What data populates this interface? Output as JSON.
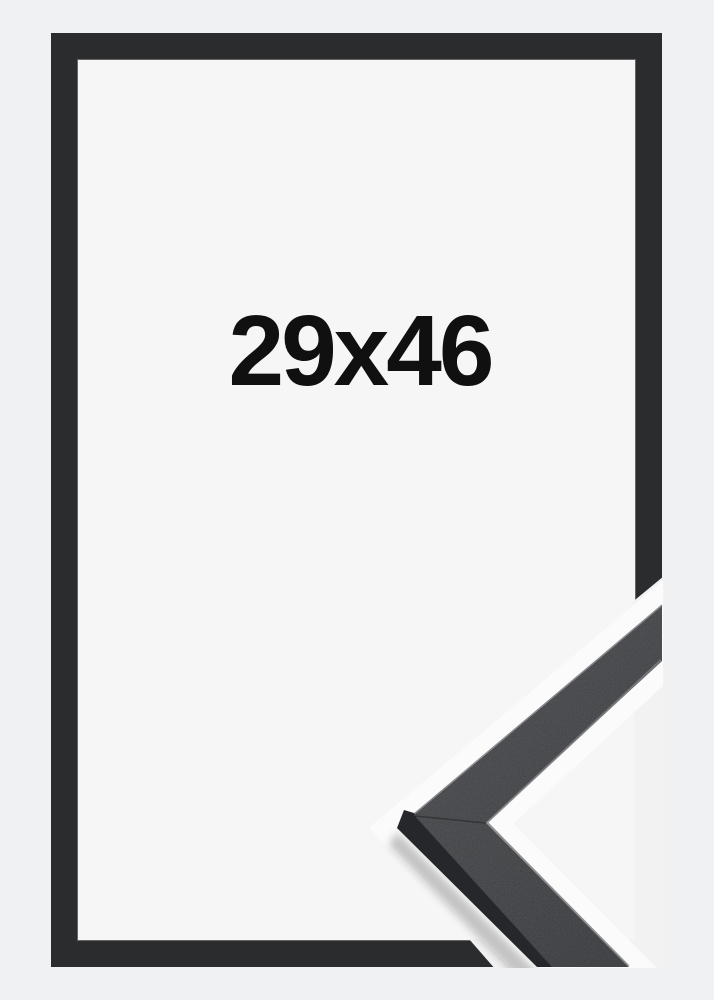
{
  "product_image": {
    "size_label": "29x46",
    "frame_color_name": "black",
    "description": "picture frame product photo with corner profile detail"
  },
  "colors": {
    "background": "#f0f1f2",
    "interior": "#f6f6f7",
    "frame": "#2b2c2e",
    "frame_inner_highlight": "#ffffff",
    "cutout": "#f2f2f3",
    "halo": "#fbfbfc",
    "detail_face": "#3a3b3e",
    "detail_face_light": "#47484b",
    "detail_face_dark": "#303134",
    "detail_side": "#26272a",
    "detail_lip": "#7d7e80",
    "detail_outer_edge": "#515356",
    "detail_seam": "#1d1e20",
    "shadow": "#1a1a1a",
    "text": "#101010"
  }
}
